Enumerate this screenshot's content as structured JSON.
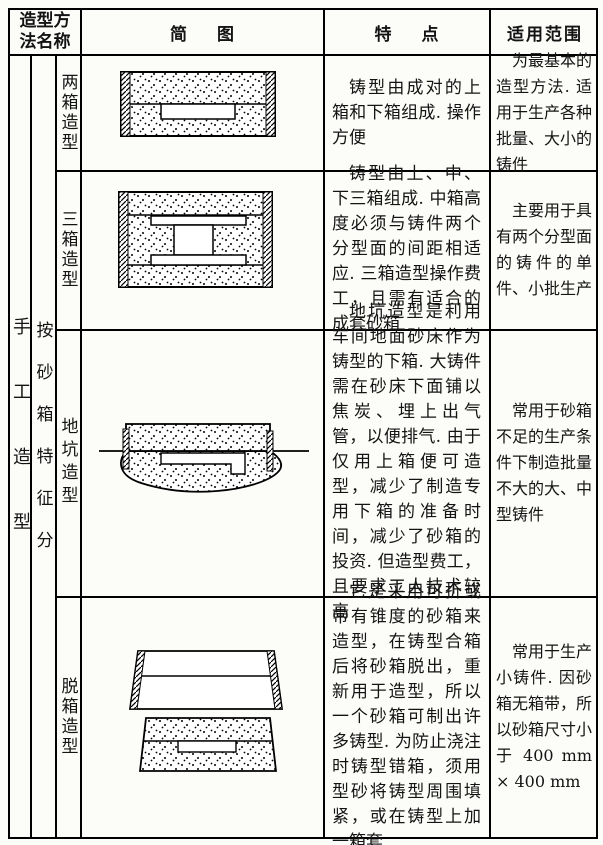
{
  "table": {
    "header": {
      "method_col_line1": "造型方",
      "method_col_line2": "法名称",
      "diagram_col": "简图",
      "features_col": "特点",
      "scope_col": "适用范围"
    },
    "classification": {
      "category": "手工造型",
      "subcategory": "按砂箱特征分"
    },
    "rows": [
      {
        "name": "两箱造型",
        "diagram": "two-box-mold-cross-section",
        "features": "铸型由成对的上箱和下箱组成. 操作方便",
        "scope": "为最基本的造型方法. 适用于生产各种批量、大小的铸件"
      },
      {
        "name": "三箱造型",
        "diagram": "three-box-mold-cross-section",
        "features": "铸型由上、中、下三箱组成. 中箱高度必须与铸件两个分型面的间距相适应. 三箱造型操作费工，且需有适合的成套砂箱",
        "scope": "主要用于具有两个分型面的铸件的单件、小批生产"
      },
      {
        "name": "地坑造型",
        "diagram": "pit-mold-cross-section",
        "features": "地坑造型是利用车间地面砂床作为铸型的下箱. 大铸件需在砂床下面铺以焦炭、埋上出气管，以便排气. 由于仅用上箱便可造型，减少了制造专用下箱的准备时间，减少了砂箱的投资. 但造型费工，且要求工人技术较高",
        "scope": "常用于砂箱不足的生产条件下制造批量不大的大、中型铸件"
      },
      {
        "name": "脱箱造型",
        "diagram": "removable-flask-mold-cross-section",
        "features": "它是采用可折或带有锥度的砂箱来造型，在铸型合箱后将砂箱脱出，重新用于造型，所以一个砂箱可制出许多铸型. 为防止浇注时铸型错箱，须用型砂将铸型周围填紧，或在铸型上加一箱套",
        "scope": "常用于生产小铸件. 因砂箱无箱带，所以砂箱尺寸小于 400 mm × 400 mm"
      }
    ]
  }
}
